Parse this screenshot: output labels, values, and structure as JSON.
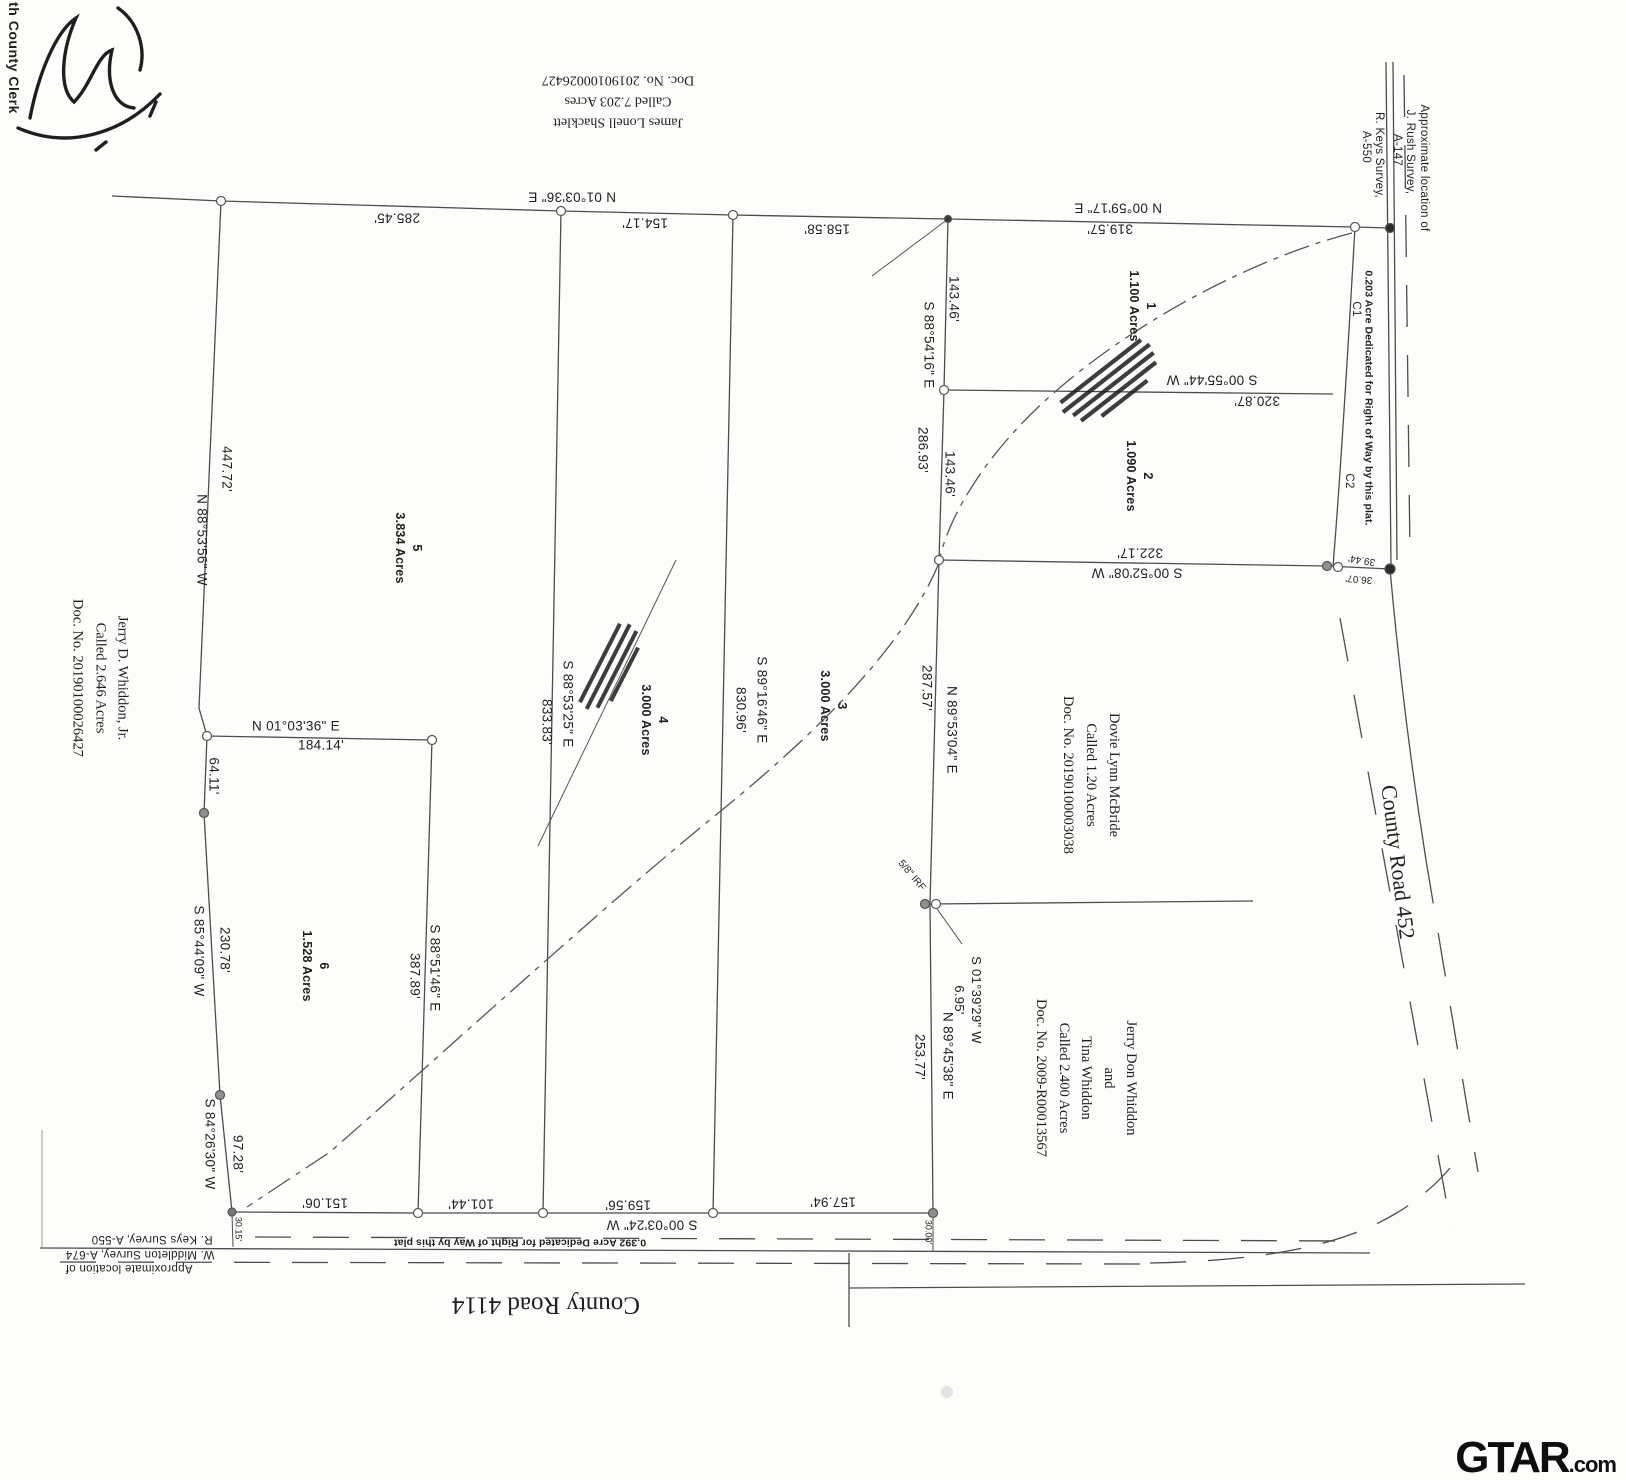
{
  "page": {
    "clerk_stamp": "th County Clerk"
  },
  "watermark": {
    "brand": "GTAR",
    "suffix": ".com"
  },
  "roads": {
    "south": "County Road 4114",
    "east": "County Road 452"
  },
  "survey_refs": {
    "northeast": {
      "l1": "Approximate location of",
      "l2": "J. Rush Survey,",
      "l3": "A-147",
      "l4": "R. Keys Survey,",
      "l5": "A-550"
    },
    "southwest": {
      "l1": "Approximate location of",
      "l2": "W. Middleton Survey, A-674",
      "l3": "R. Keys Survey, A-550"
    }
  },
  "dedications": {
    "east_row": "0.203 Acre Dedicated for Right of Way by this plat.",
    "south_row": "0.392 Acre Dedicated for Right of Way by this plat"
  },
  "adjoining_owners": {
    "shacklett": {
      "l1": "James Lonell Shacklett",
      "l2": "Called 7.203 Acres",
      "l3": "Doc. No. 20190100026427"
    },
    "whiddon_jr": {
      "l1": "Jerry D. Whiddon, Jr.",
      "l2": "Called 2.646 Acres",
      "l3": "Doc. No. 20190100026427"
    },
    "mcbride": {
      "l1": "Dovie Lynn McBride",
      "l2": "Called 1.20 Acres",
      "l3": "Doc. No. 20190100003038"
    },
    "whiddon": {
      "l1": "Jerry Don Whiddon",
      "l2": "and",
      "l3": "Tina Whiddon",
      "l4": "Called 2.400 Acres",
      "l5": "Doc. No. 2009-R00013567"
    }
  },
  "lots": [
    {
      "number": "1",
      "acreage": "1.100 Acres"
    },
    {
      "number": "2",
      "acreage": "1.090 Acres"
    },
    {
      "number": "3",
      "acreage": "3.000 Acres"
    },
    {
      "number": "4",
      "acreage": "3.000 Acres"
    },
    {
      "number": "5",
      "acreage": "3.834 Acres"
    },
    {
      "number": "6",
      "acreage": "1.528 Acres"
    }
  ],
  "dimensions": {
    "top_b1": "N 01°03'36\" E",
    "top_d1": "285.45'",
    "top_d2": "154.17'",
    "top_d3": "158.58'",
    "top_b2": "N 00°59'17\" E",
    "top_d4": "319.57'",
    "west_b1": "N 88°53'56\" W",
    "west_d1": "447.72'",
    "west_d2": "64.11'",
    "west_b2": "S 85°44'09\" W",
    "west_d3": "230.78'",
    "west_b3": "S 84°26'30\" W",
    "west_d4": "97.28'",
    "mid_b1": "N 01°03'36\" E",
    "mid_d1": "184.14'",
    "lot6_b": "S 88°51'46\" E",
    "lot6_d": "387.89'",
    "lot45_b": "S 88°53'25\" E",
    "lot45_d": "833.83'",
    "lot34_b": "S 89°16'46\" E",
    "lot34_d": "830.96'",
    "east_b1": "S 88°54'16\" E",
    "east_d1": "286.93'",
    "east_d1a": "143.46'",
    "east_d1b": "143.46'",
    "lot12_b": "S 00°55'44\" W",
    "lot12_d": "320.87'",
    "east_b2": "S 00°52'08\" W",
    "east_d2": "322.17'",
    "east_b3": "N 89°53'04\" E",
    "east_d3": "287.57'",
    "east_b4": "N 89°45'38\" E",
    "east_d4": "253.77'",
    "jog_b": "S 01°39'29\" W",
    "jog_d": "6.95'",
    "south_b": "S 00°03'24\" W",
    "south_d1": "151.06'",
    "south_d2": "101.44'",
    "south_d3": "159.56'",
    "south_d4": "157.94'",
    "corner_d1": "39.44'",
    "corner_d2": "36.07'",
    "tick_sw": "30.15'",
    "tick_se": "30.00'"
  },
  "curve_labels": {
    "c1": "C1",
    "c2": "C2"
  },
  "monuments": {
    "irf": "5/8\" IRF"
  }
}
